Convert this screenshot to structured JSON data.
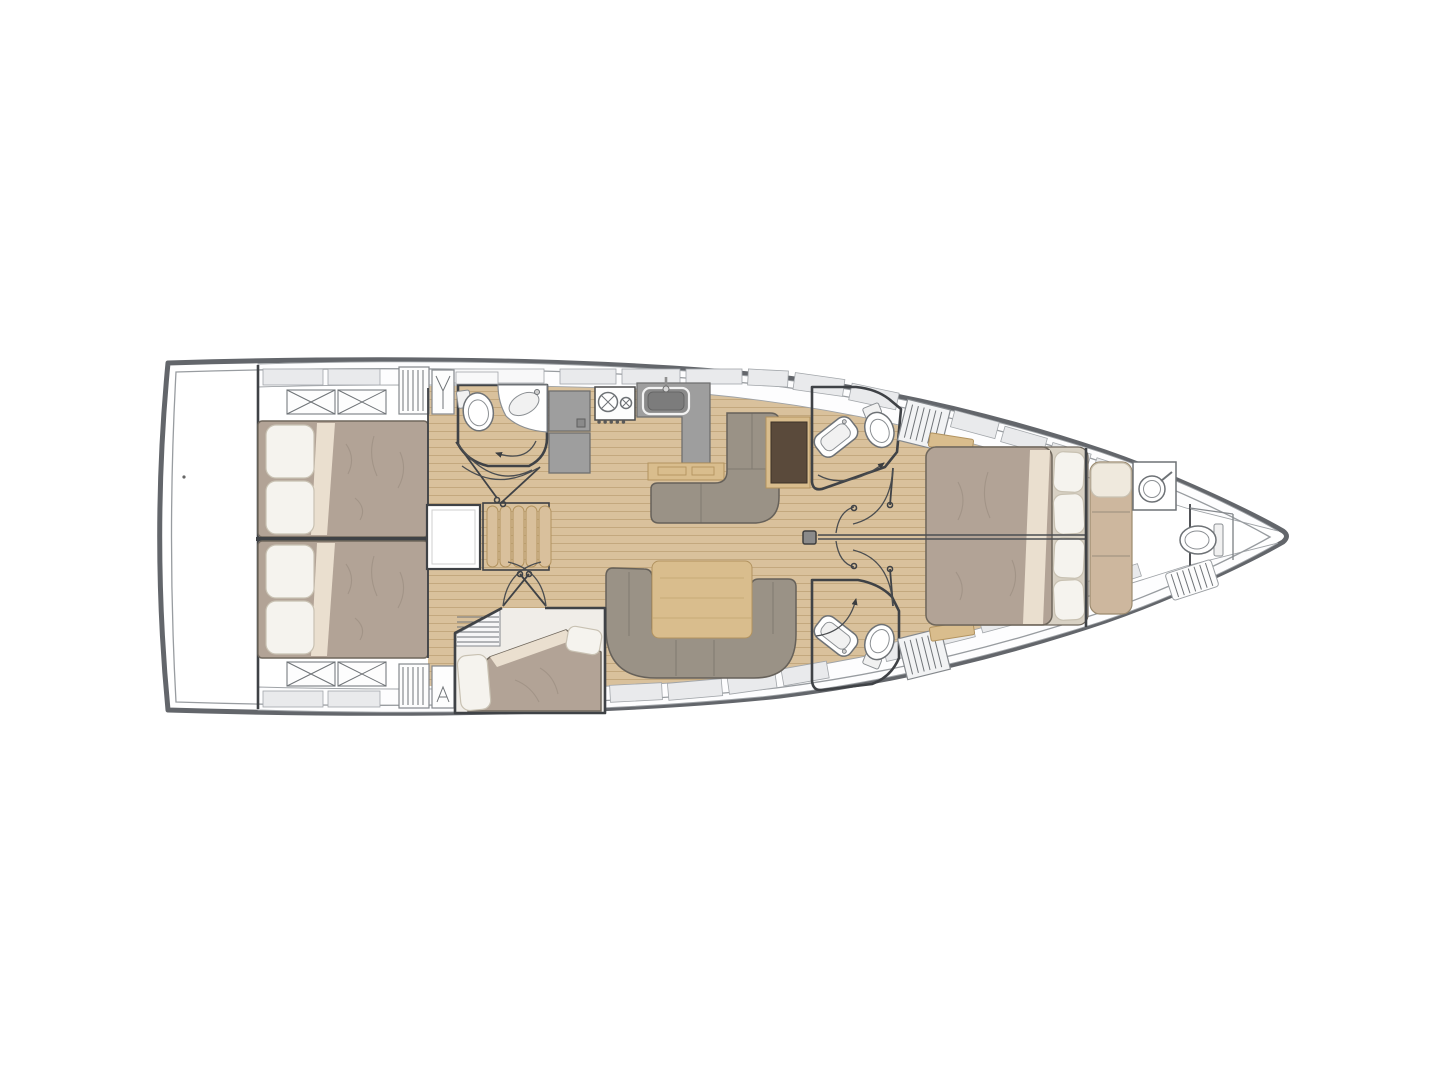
{
  "diagram": {
    "type": "floor-plan",
    "subject": "sailing-yacht-interior-layout-top-view",
    "orientation": "bow-right-stern-left",
    "rooms": [
      {
        "id": "swim-platform",
        "label": "transom platform"
      },
      {
        "id": "aft-cabin-starboard",
        "label": "aft cabin (top)",
        "items": [
          "double-bed",
          "pillows",
          "crossed-lockers",
          "slatted-locker",
          "hanging-locker"
        ]
      },
      {
        "id": "aft-cabin-port",
        "label": "aft cabin (bottom)",
        "items": [
          "double-bed",
          "pillows",
          "crossed-lockers",
          "slatted-locker",
          "vent-locker"
        ]
      },
      {
        "id": "companionway",
        "label": "companionway",
        "items": [
          "engine-compartment",
          "steps"
        ]
      },
      {
        "id": "aft-head",
        "label": "aft head (wc)",
        "items": [
          "toilet",
          "vanity-sink",
          "door-swing"
        ]
      },
      {
        "id": "galley",
        "label": "galley",
        "items": [
          "refrigerator",
          "two-burner-stove",
          "sink",
          "l-counter"
        ]
      },
      {
        "id": "salon",
        "label": "salon",
        "items": [
          "l-sofa",
          "sideboard",
          "dining-table",
          "u-sofa",
          "mast-post"
        ]
      },
      {
        "id": "mid-cabin",
        "label": "mid cabin (bottom)",
        "items": [
          "berth",
          "pillows",
          "access-steps"
        ]
      },
      {
        "id": "head-starboard",
        "label": "forward head (top)",
        "items": [
          "toilet",
          "vanity-sink",
          "vent-grille",
          "door-swing"
        ]
      },
      {
        "id": "head-port",
        "label": "forward head (bottom)",
        "items": [
          "toilet",
          "vanity-sink",
          "vent-grille",
          "door-swing"
        ]
      },
      {
        "id": "forward-cabin",
        "label": "forward owner cabin",
        "items": [
          "island-double-bed",
          "pillows",
          "bedside-shelves",
          "split-door"
        ]
      },
      {
        "id": "bow-head",
        "label": "bow head / skipper area",
        "items": [
          "bench-berth",
          "washbasin",
          "toilet",
          "shower-grate"
        ]
      }
    ]
  },
  "colors": {
    "hull_outline": "#63666b",
    "inner_liner": "#989ca0",
    "interior_wall": "#3f4246",
    "deck": "#fdfdfe",
    "deck_panel": "#e9eaec",
    "panel_edge": "#a2a6aa",
    "floor_wood": "#d9c19c",
    "floor_plank_line": "#c3a87e",
    "head_floor": "#f0ede8",
    "duvet": "#b2a396",
    "bed_base": "#d8d1c4",
    "pillow": "#f5f3ee",
    "linen_fold": "#eadfcf",
    "sofa": "#9a9286",
    "table_wood": "#d9bd8d",
    "sideboard_dark": "#5a4a3b",
    "appliance_gray": "#9e9e9e",
    "sink_basin": "#8a8a8a",
    "fixture_white": "#ffffff",
    "step_wood": "#d9c09c",
    "berth_cushion": "#cdb79e",
    "swing_arc": "#4a4d50"
  }
}
